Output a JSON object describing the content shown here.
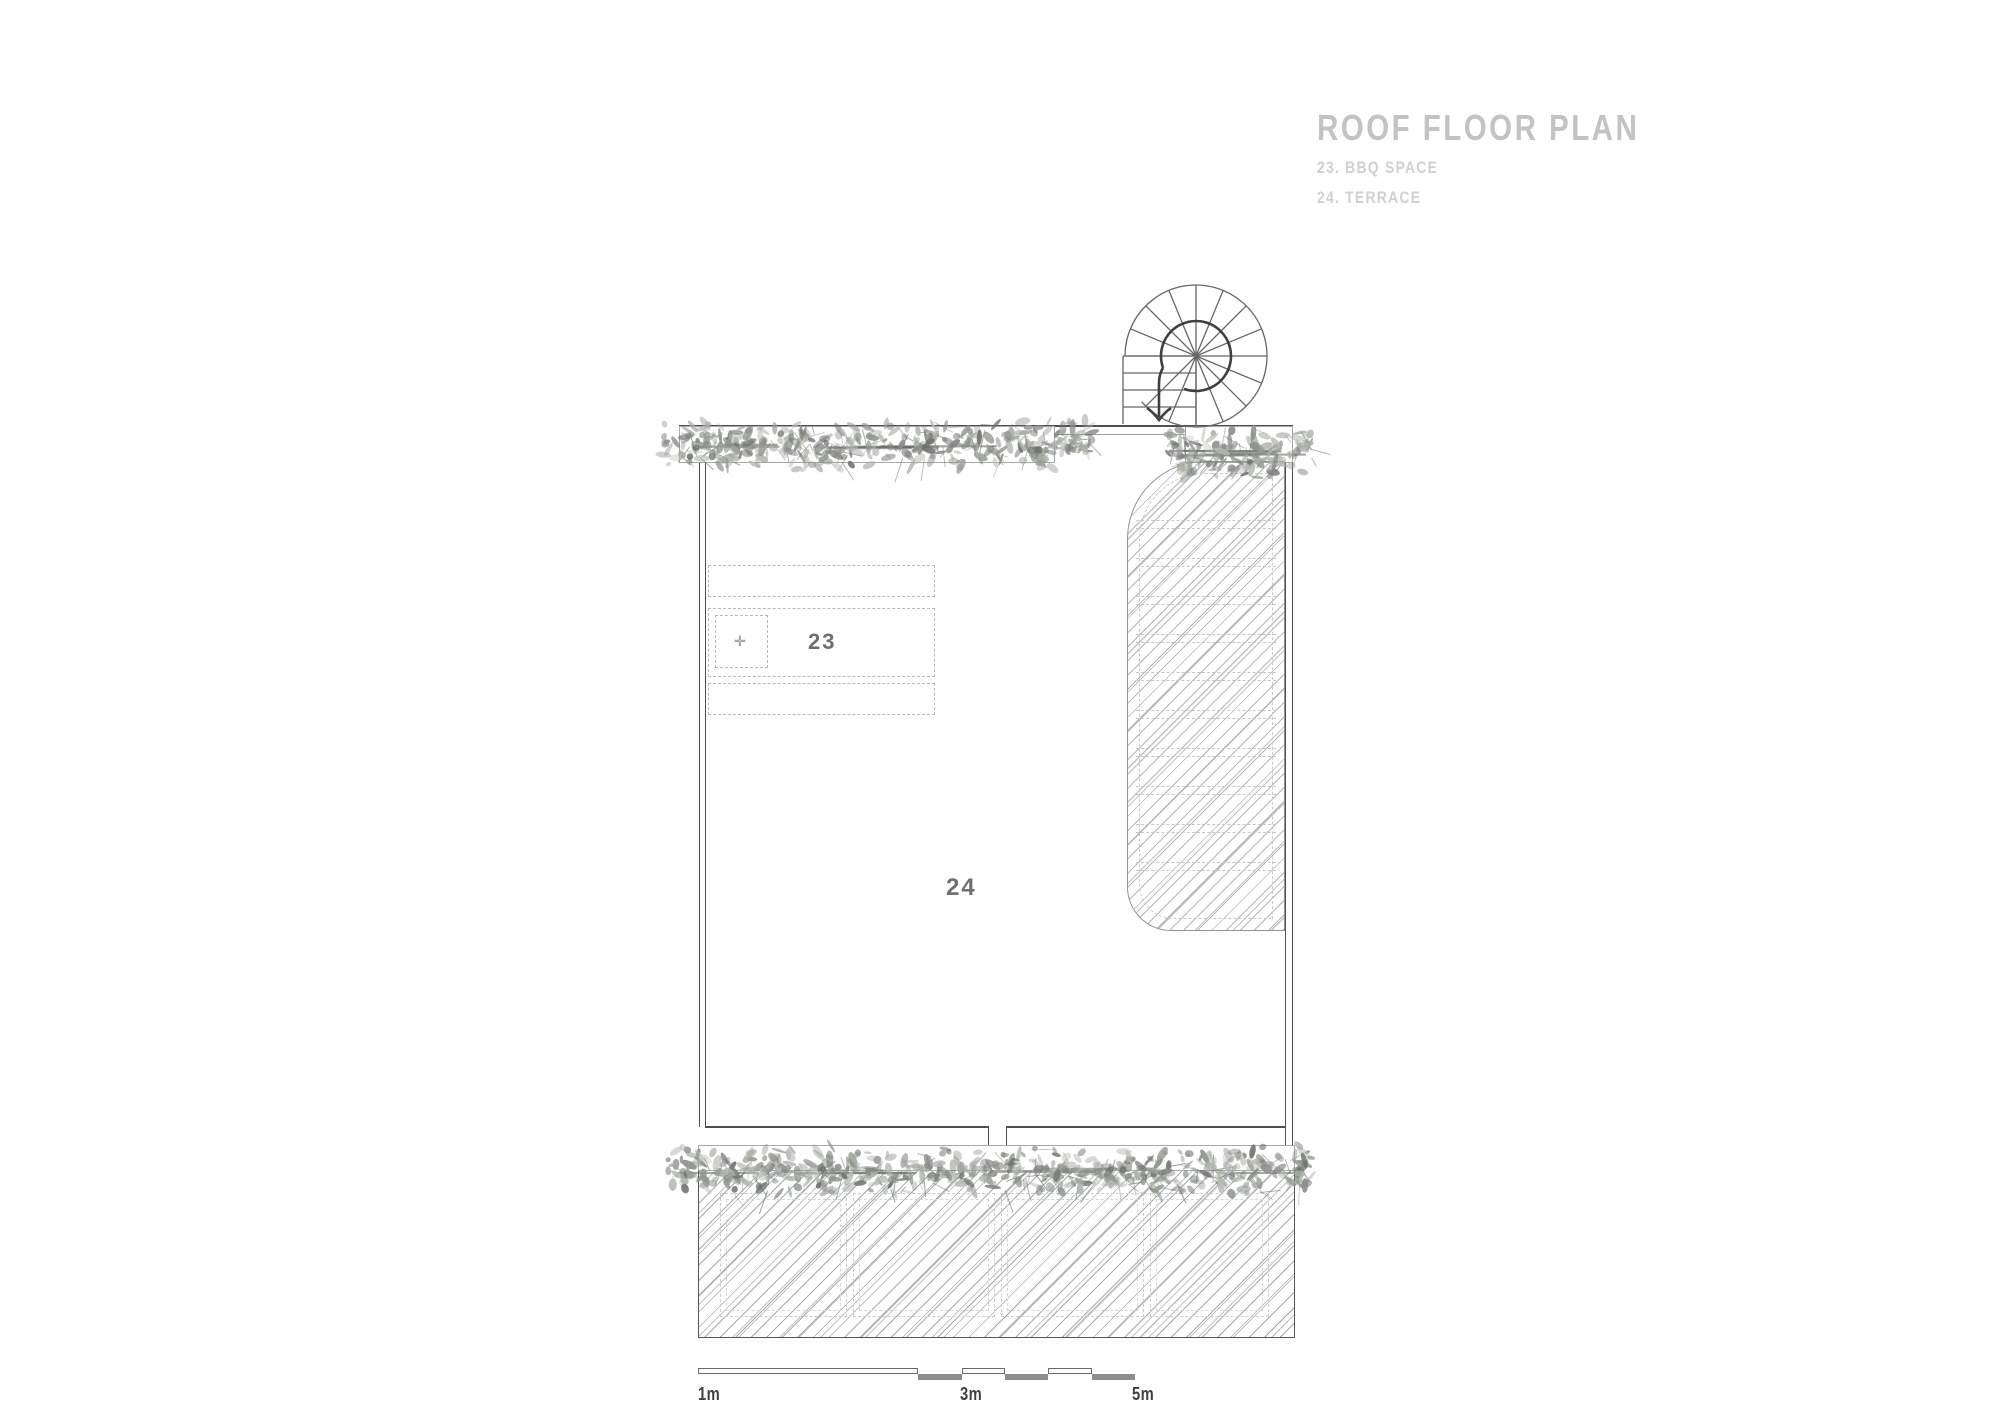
{
  "title_block": {
    "title": "ROOF FLOOR PLAN",
    "legend": [
      {
        "text": "23. BBQ SPACE"
      },
      {
        "text": "24. TERRACE"
      }
    ]
  },
  "plan": {
    "bbq_label": "23",
    "terrace_label": "24",
    "fixture_glyph": "✛"
  },
  "scale_bar": {
    "labels": [
      "1m",
      "3m",
      "5m"
    ]
  },
  "colors": {
    "title": "#c3c3c3",
    "legend": "#d0d0d0",
    "wall": "#4f4f4f",
    "wall_light": "#9d9d9d",
    "stair_line": "#666666",
    "walk_line": "#3f3f3f",
    "hatch": "#9ea4a6",
    "dashed": "#c6c6c6",
    "room_label": "#6f6f6f",
    "scale_text": "#3f3f3f",
    "scale_fill": "#8d8d8d",
    "foliage_dark": "#6e726d",
    "foliage_mid": "#8a8f88",
    "foliage_light": "#aab0a8"
  }
}
